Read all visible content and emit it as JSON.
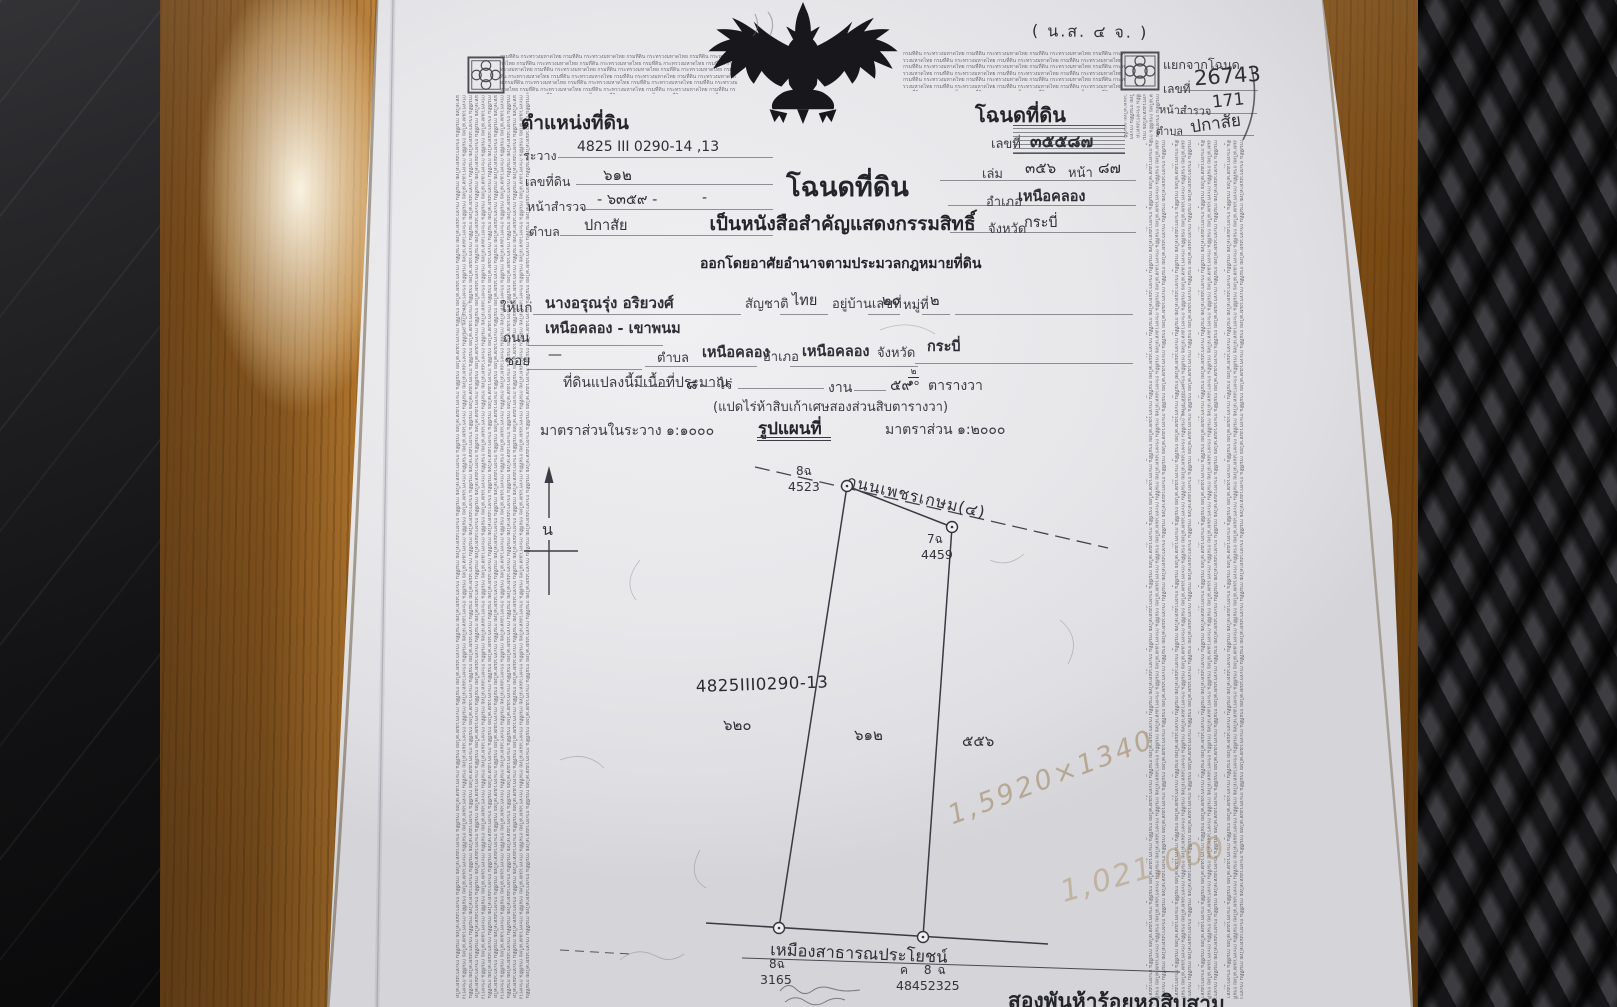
{
  "palette": {
    "paper": "#e9e9ec",
    "ink": "#2c2c33",
    "wood": "#a86c28",
    "weave_dark": "#2a2a2d",
    "pencil": "#9a7d4e"
  },
  "security": {
    "microtext": "กรมที่ดิน กระทรวงมหาดไทย "
  },
  "form_code": "( น.ส. ๔ จ. )",
  "split_note": {
    "line1_label": "แยกจากโฉนด",
    "line2_label": "เลขที่",
    "line2_value": "26743",
    "line3_label": "หน้าสำรวจ",
    "line3_value": "171",
    "line4_label": "ตำบล",
    "line4_value": "ปกาสัย"
  },
  "position": {
    "header": "ตำแหน่งที่ดิน",
    "rawang_label": "ระวาง",
    "rawang_value": "4825 III 0290-14 ,13",
    "parcel_label": "เลขที่ดิน",
    "parcel_value": "๖๑๒",
    "survey_label": "หน้าสำรวจ",
    "survey_value": "- ๖๓๕๙ -",
    "survey_extra": "-",
    "tambon_label": "ตำบล",
    "tambon_value": "ปกาสัย"
  },
  "deed": {
    "header": "โฉนดที่ดิน",
    "number_label": "เลขที่",
    "number_value": "๓๕๕๘๗",
    "volume_label": "เล่ม",
    "volume_value": "๓๕๖",
    "page_label": "หน้า",
    "page_value": "๘๗",
    "amphoe_label": "อำเภอ",
    "amphoe_value": "เหนือคลอง",
    "changwat_label": "จังหวัด",
    "changwat_value": "กระบี่"
  },
  "title": {
    "main": "โฉนดที่ดิน",
    "sub1": "เป็นหนังสือสำคัญแสดงกรรมสิทธิ์",
    "sub2": "ออกโดยอาศัยอำนาจตามประมวลกฎหมายที่ดิน"
  },
  "owner": {
    "grant_label": "ให้แก่",
    "name": "นางอรุณรุ่ง อริยวงศ์",
    "nationality_label": "สัญชาติ",
    "nationality": "ไทย",
    "address_label": "อยู่บ้านเลขที่",
    "address_no": "๒๐",
    "moo_label": "หมู่ที่",
    "moo": "๒",
    "road_label": "ถนน",
    "road": "เหนือคลอง - เขาพนม",
    "soi_label": "ซอย",
    "soi": "—",
    "tambon_label": "ตำบล",
    "tambon": "เหนือคลอง",
    "amphoe_label": "อำเภอ",
    "amphoe": "เหนือคลอง",
    "changwat_label": "จังหวัด",
    "changwat": "กระบี่"
  },
  "area": {
    "intro": "ที่ดินแปลงนี้มีเนื้อที่ประมาณ",
    "dash": "—",
    "rai_value": "๘",
    "rai_label": "ไร่",
    "ngan_label": "งาน",
    "wa_value": "๕๙",
    "wa_frac_num": "๒",
    "wa_frac_den": "๑๐",
    "wa_label": "ตารางวา",
    "spelled_out": "(แปดไร่ห้าสิบเก้าเศษสองส่วนสิบตารางวา)"
  },
  "map": {
    "scale_left": "มาตราส่วนในระวาง ๑:๑๐๐๐",
    "title": "รูปแผนที่",
    "scale_right": "มาตราส่วน ๑:๒๐๐๐",
    "north": "น",
    "road_name": "ถนนเพชรเกษม(๔)",
    "sheet_note": "4825III0290-13",
    "left_parcel": "๖๒๐",
    "center_parcel": "๖๑๒",
    "right_parcel": "๕๕๖",
    "marker_tl_id": "8ฉ",
    "marker_tl_num": "4523",
    "marker_tr_id": "7ฉ",
    "marker_tr_num": "4459",
    "marker_bl_id": "8ฉ",
    "marker_bl_num": "3165",
    "marker_br_id": "ค 8ฉ",
    "marker_br_num": "48452325",
    "south_boundary": "เหมืองสาธารณประโยชน์"
  },
  "annotations": {
    "pencil_dims": "1,5920×1340",
    "pencil_price": "1,021,000",
    "bottom_text": "สองพันห้าร้อยหกสิบสาม"
  }
}
